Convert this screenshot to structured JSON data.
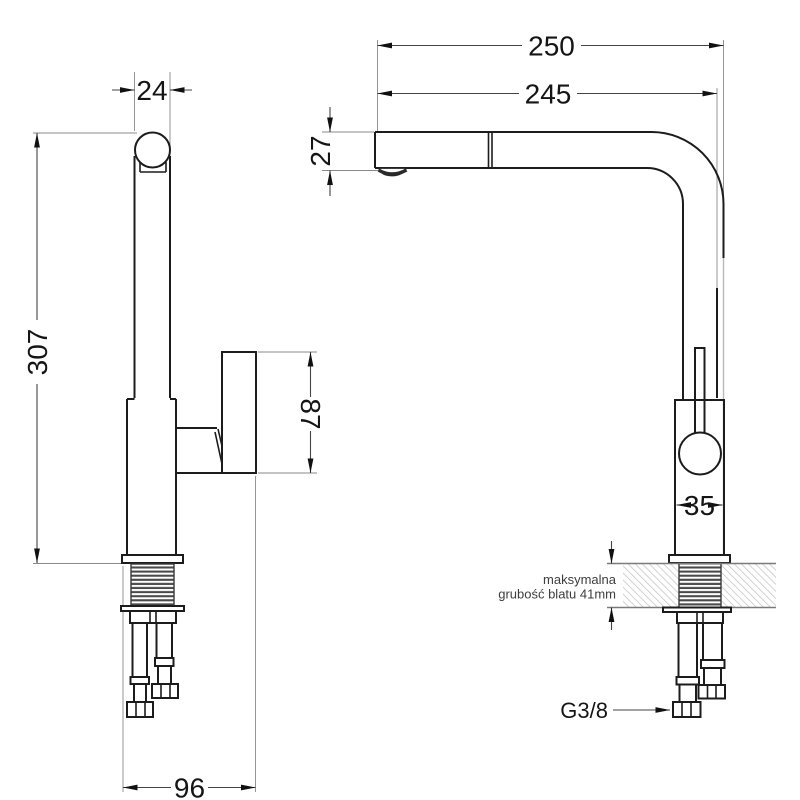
{
  "drawing": {
    "type": "technical-dimension-drawing",
    "subject": "kitchen-faucet-two-views",
    "left_view": {
      "dims": {
        "column_width": "24",
        "total_height": "307",
        "handle_length": "87",
        "base_depth": "96"
      }
    },
    "right_view": {
      "dims": {
        "spout_reach_outer": "250",
        "spout_reach_inner": "245",
        "spout_height": "27",
        "body_width": "35"
      },
      "countertop_note": {
        "line1": "maksymalna",
        "line2": "grubość blatu 41mm"
      },
      "thread_label": "G3/8"
    },
    "colors": {
      "line": "#1c1c1c",
      "dim_line": "#444444",
      "hatch": "#c6c6c6",
      "thread": "#4a4a4a",
      "background": "#ffffff"
    }
  }
}
